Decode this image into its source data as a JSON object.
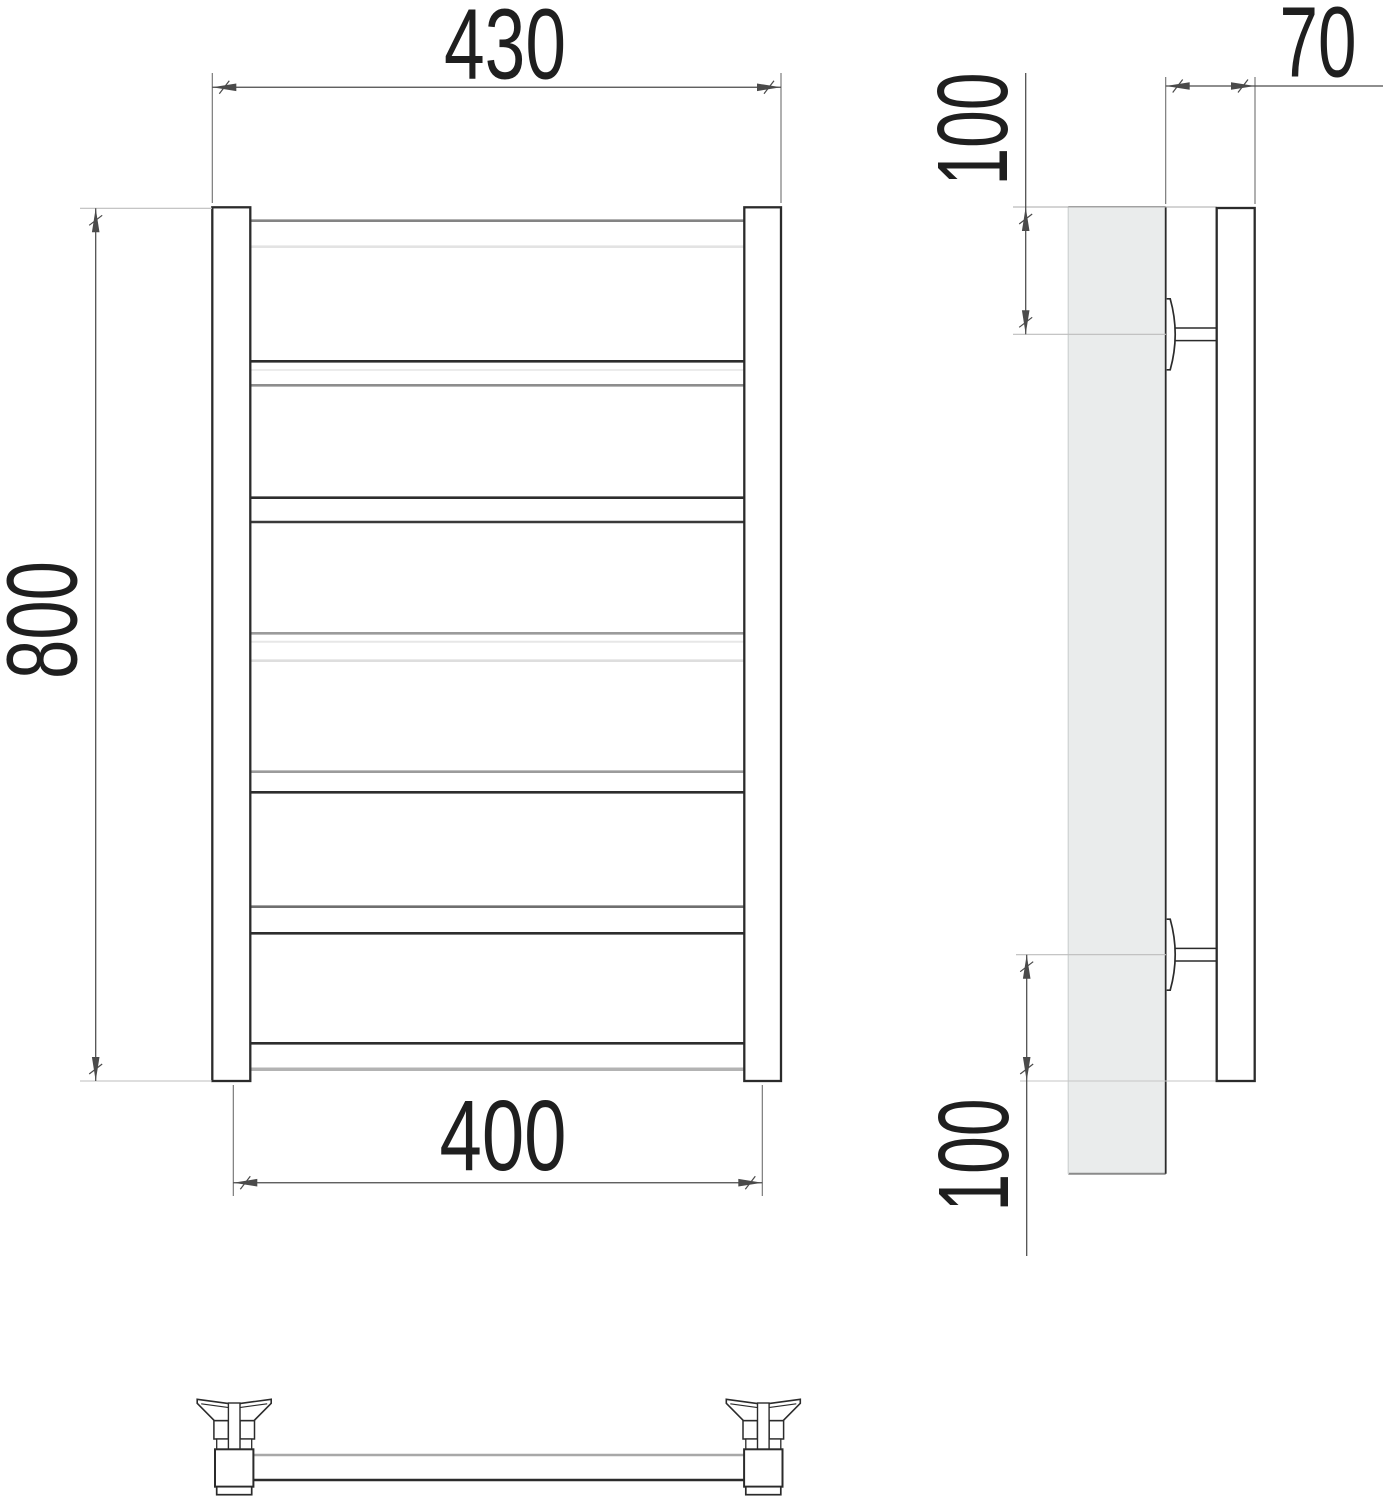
{
  "drawing_type": "technical-drawing-towel-rail",
  "views": [
    "front",
    "side",
    "bottom"
  ],
  "colors": {
    "line_dark": "#2b2b2b",
    "dim_line": "#4a4a4a",
    "ext_line": "#6f6f6f",
    "ref_faint": "#bdbdbd",
    "panel_fill": "#eaecec",
    "text": "#1f1f1f",
    "background": "#ffffff"
  },
  "front_view": {
    "posts": {
      "left": {
        "x": 212.3,
        "w": 38.0
      },
      "right": {
        "x": 744.3,
        "w": 36.7
      },
      "y_top": 207.3,
      "y_bottom": 1081
    },
    "bars": [
      {
        "y1": 220.7,
        "y2": 246.7,
        "c1": "#848484",
        "c2": "#e3e3e3"
      },
      {
        "y1": 361.3,
        "y2": 385.3,
        "c1": "#2d2d2d",
        "c2": "#8d8d8d",
        "yi": 370,
        "ci": "#ececec"
      },
      {
        "y1": 497.7,
        "y2": 522.0,
        "c1": "#2d2d2d",
        "c2": "#3a3a3a"
      },
      {
        "y1": 633.3,
        "y2": 660.7,
        "c1": "#9b9b9b",
        "c2": "#dedede",
        "yi": 641.7,
        "ci": "#e7e7e7"
      },
      {
        "y1": 771.7,
        "y2": 792.3,
        "c1": "#9b9b9b",
        "c2": "#2d2d2d"
      },
      {
        "y1": 906.7,
        "y2": 933.3,
        "c1": "#6f6f6f",
        "c2": "#2d2d2d"
      },
      {
        "y1": 1043.3,
        "y2": 1069.3,
        "c1": "#2d2d2d",
        "c2": "#b3b3b3",
        "w2": 3.5
      }
    ]
  },
  "side_view": {
    "panel": {
      "x": 1068.3,
      "y": 206.7,
      "w": 97.4,
      "h": 967
    },
    "tube": {
      "x": 1216.7,
      "y": 208,
      "w": 38,
      "h": 873
    },
    "bracket_shape": {
      "face_x": 1166.7,
      "bulge": 9.5,
      "half_h": 35.5,
      "stem_x2": 1216.7,
      "stem_half": 6.3
    },
    "brackets": [
      {
        "cy": 334.3
      },
      {
        "cy": 954.7
      }
    ],
    "ref_lines": [
      {
        "x1": 1013,
        "y1": 207,
        "x2": 1216.7,
        "y2": 207,
        "c": "#a8a8a8"
      },
      {
        "x1": 1013,
        "y1": 334.3,
        "x2": 1166,
        "y2": 334.3,
        "c": "#bdbdbd"
      },
      {
        "x1": 1016,
        "y1": 954.7,
        "x2": 1166,
        "y2": 954.7,
        "c": "#bdbdbd"
      },
      {
        "x1": 1020,
        "y1": 1081,
        "x2": 1216.7,
        "y2": 1081,
        "c": "#c6c6c6"
      }
    ]
  },
  "bottom_view": {
    "fitting_centers": [
      234.2,
      763.3
    ],
    "plate": {
      "y_top": 1399.3,
      "dip": 5,
      "half_top": 37,
      "corner_y": 1403.3,
      "half_bottom": 19.8,
      "y_bottom": 1420.7
    },
    "collar": {
      "outer_half": 20.3,
      "inner_half": 5.8,
      "y1": 1420.7,
      "y2": 1439
    },
    "neck": {
      "half": 17.5,
      "y1": 1439,
      "y2": 1449.3
    },
    "stem": {
      "half": 5.8,
      "y1": 1403,
      "y2": 1449.3
    },
    "block": {
      "half": 19.2,
      "y1": 1449.3,
      "y2": 1486.7
    },
    "foot": {
      "half": 17.5,
      "y1": 1486.7,
      "y2": 1494.7
    },
    "bar": {
      "y1": 1455,
      "y2": 1480,
      "c1": "#a8a8a8",
      "c2": "#2b2b2b"
    }
  },
  "dimensions": [
    {
      "id": "overall-width",
      "label": "430",
      "orient": "h",
      "line": 87.3,
      "ref1": 212.3,
      "ref2": 781,
      "ext_from": 73,
      "ext_to": 203,
      "text": {
        "x": 505,
        "y": 78.3,
        "len": 122
      }
    },
    {
      "id": "overall-height",
      "label": "800",
      "orient": "v",
      "line": 95.7,
      "ref1": 208.3,
      "ref2": 1081,
      "ref_ticks": {
        "x1": 80,
        "x2": 212
      },
      "text": {
        "x": 76.7,
        "y": 620,
        "len": 118,
        "rot": -90
      }
    },
    {
      "id": "bottom-width",
      "label": "400",
      "orient": "h",
      "line": 1182.7,
      "ref1": 233.3,
      "ref2": 762.3,
      "ext_from": 1085,
      "ext_to": 1196,
      "text": {
        "x": 503,
        "y": 1170,
        "len": 127
      }
    },
    {
      "id": "top-offset",
      "label": "100",
      "orient": "v",
      "line": 1025.7,
      "ref1": 207,
      "ref2": 334.3,
      "tail1": 134,
      "text": {
        "x": 1007,
        "y": 129,
        "len": 113,
        "rot": -90
      }
    },
    {
      "id": "depth",
      "label": "70",
      "orient": "h",
      "line": 86,
      "ref1": 1165.7,
      "ref2": 1255,
      "ext_from": 77,
      "ext_to": 204,
      "tail2": 128,
      "text": {
        "x": 1318,
        "y": 76.7,
        "len": 77
      }
    },
    {
      "id": "bottom-offset",
      "label": "100",
      "orient": "v",
      "line": 1026.7,
      "ref1": 954.7,
      "ref2": 1081,
      "tail2": 175,
      "text": {
        "x": 1008,
        "y": 1155,
        "len": 113,
        "rot": -90
      }
    }
  ]
}
